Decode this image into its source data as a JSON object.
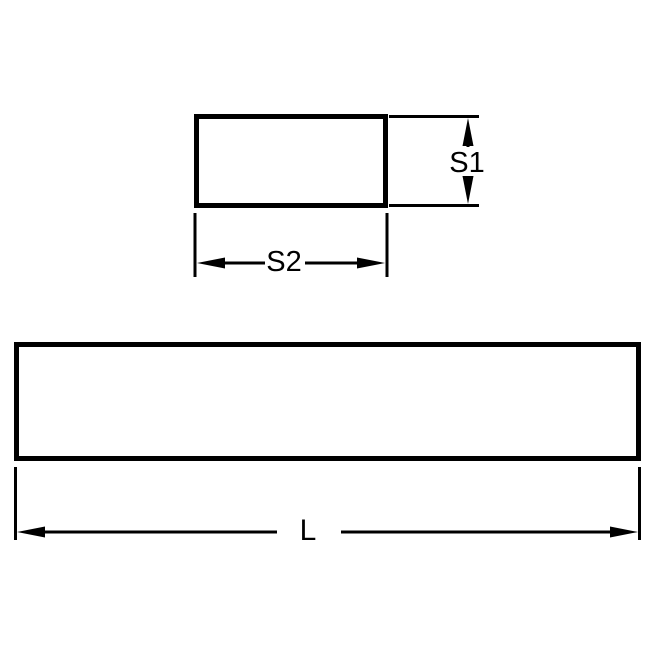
{
  "diagram": {
    "colors": {
      "background": "#ffffff",
      "line": "#000000",
      "text": "#000000"
    },
    "cross_section": {
      "height_label": "S1",
      "width_label": "S2"
    },
    "side_view": {
      "length_label": "L"
    }
  }
}
